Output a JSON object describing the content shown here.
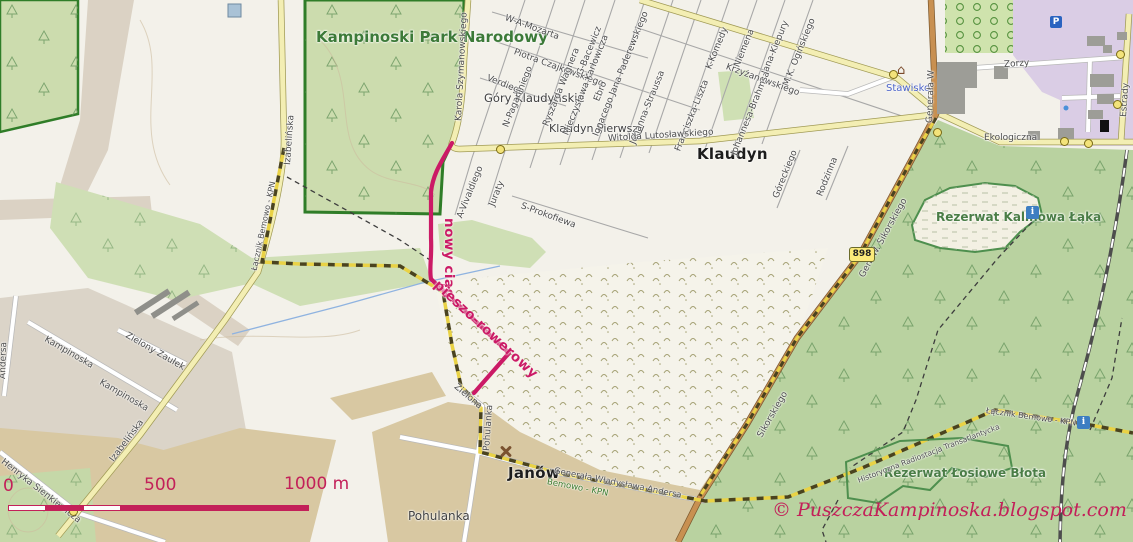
{
  "places": {
    "park": "Kampinoski Park Narodowy",
    "gory_klaudynskie": "Góry Klaudyńskie",
    "klaudyn_pierwszy": "Klaudyn Pierwszy",
    "klaudyn": "Klaudyn",
    "stawisko": "Stawisko",
    "rezerwat_kalinowa": "Rezerwat Kalinowa Łąka",
    "rezerwat_losiowe": "Rezerwat Łosiowe Błota",
    "janow": "Janów",
    "pohulanka": "Pohulanka"
  },
  "streets": {
    "szymanowskiego": "Karola Szymanowskiego",
    "mozarta": "W-A-Mozarta",
    "bacewicz": "G-Bacewicz",
    "czajkowskiego": "Piotra Czajkowskiego",
    "verdiego": "Verdiego",
    "paganiniego": "N-Paganiniego",
    "wagnera": "Ryszarda Wagnera",
    "karlowicza": "Mieczysława Karłowicza",
    "ebro": "Ebro",
    "paderewskiego": "Ignacego Jana Paderewskiego",
    "straussa": "Johanna-Straussa",
    "komedy": "K-Komedy",
    "niemena": "Niemena",
    "kiepury": "Jana-Kiepury",
    "oginskiego": "M.K. Ogińskiego",
    "krzyzanowskiego": "Krzyżanowskiego",
    "liszta": "Franciszka-Liszta",
    "brahmsa": "Johannesa-Brahmsa",
    "goreckiego": "Góreckiego",
    "rodzinna": "Rodzinna",
    "vivaldiego": "A-Vivaldiego",
    "juraty": "Juraty",
    "prokofiewa": "S-Prokofiewa",
    "lutoslawskiego": "Witolda Lutosławskiego",
    "generala_w": "Generała W",
    "sikorskiego_full": "Gen. W. Sikorskiego",
    "sikorskiego": "Sikorskiego",
    "zorzy": "Zorzy",
    "estrady": "Estrady",
    "ekologiczna": "Ekologiczna",
    "izabelinska": "Izabelińska",
    "kampinoska": "Kampinoska",
    "zielony_zaulek": "Zielony Zaułek",
    "sienkiewicza": "Henryka Sienkiewicza",
    "andersa": "Generała Władysława Andersa",
    "andersa_short": "Andersa",
    "zielona": "Zielona",
    "pohulanka_street": "Pohulanka"
  },
  "trails": {
    "lacznik": "Łącznik Bemowo - KPN",
    "bemowo_kpn": "Bemowo - KPN",
    "radiostacja": "Historyczna Radiostacja Transatlantycka"
  },
  "route_annotation": {
    "line1": "nowy ciąg",
    "line2": "pieszo-rowerowy"
  },
  "road_shield": "898",
  "icons": {
    "parking": "P",
    "info": "i",
    "museum": "⌂"
  },
  "scale_bar": {
    "start": "0",
    "middle": "500",
    "end": "1000 m"
  },
  "copyright": "© PuszczaKampinoska.blogspot.com",
  "colors": {
    "route": "#cb1a66",
    "scale_text": "#c32059",
    "park_label": "#3c7a38",
    "reserve_label": "#4a7d46",
    "place_blue": "#4b63c8",
    "trail_label_green": "#3b7a2a",
    "park_fill": "#ccdcae",
    "forest_fill": "#b9d2a0",
    "purple_zone": "#dacde5",
    "residential_tan": "#d8c8a2",
    "road_yellow": "#f3eeb3",
    "road_brown": "#c89051"
  }
}
